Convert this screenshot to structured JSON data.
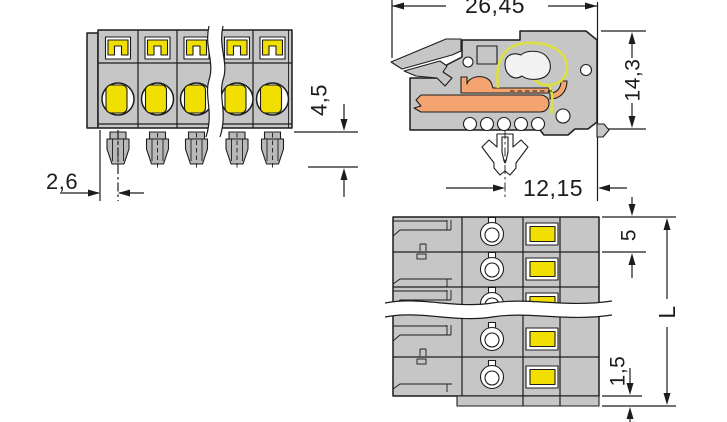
{
  "dims": {
    "overall_depth": "26,45",
    "overall_height": "14,3",
    "foot_to_front_edge": "12,15",
    "pin_length": "4,5",
    "pin_offset": "2,6",
    "pole_pitch": "5",
    "end_wall_thickness": "1,5",
    "total_length": "L"
  },
  "colors": {
    "housing_grey": "#c6c6c6",
    "contact_grey": "#b9b9b9",
    "accent_yellow": "#f0df00",
    "wire_orange": "#f5a470",
    "spring_yellow": "#dde041",
    "recess_white": "#ffffff"
  }
}
